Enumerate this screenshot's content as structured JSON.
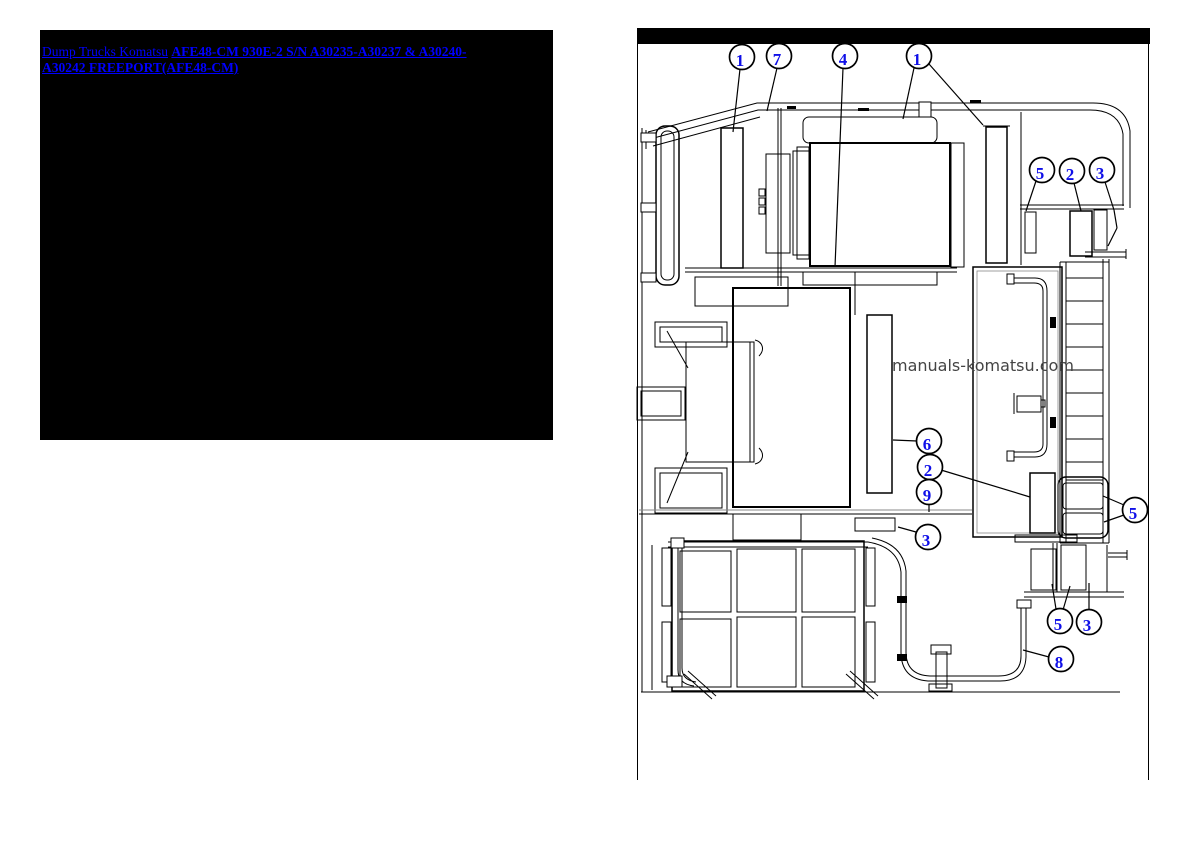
{
  "left_panel": {
    "category_link": "Dump Trucks Komatsu",
    "model_link": "AFE48-CM 930E-2 S/N A30235-A30237 & A30240-A30242 FREEPORT(AFE48-CM)",
    "link_color": "#0000ff",
    "bg_color": "#000000"
  },
  "diagram": {
    "watermark": "manuals-komatsu.com",
    "callout_color": "#0f0fe8",
    "callouts": [
      {
        "label": "1",
        "cx": 742,
        "cy": 57,
        "leaders": [
          [
            740,
            69,
            733,
            132
          ]
        ]
      },
      {
        "label": "7",
        "cx": 779,
        "cy": 56,
        "leaders": [
          [
            777,
            68,
            767,
            111
          ]
        ]
      },
      {
        "label": "4",
        "cx": 845,
        "cy": 56,
        "leaders": [
          [
            843,
            68,
            835,
            267
          ]
        ]
      },
      {
        "label": "1",
        "cx": 919,
        "cy": 56,
        "leaders": [
          [
            914,
            68,
            903,
            119
          ],
          [
            929,
            64,
            983,
            125
          ]
        ]
      },
      {
        "label": "5",
        "cx": 1042,
        "cy": 170,
        "leaders": [
          [
            1036,
            181,
            1026,
            211
          ]
        ]
      },
      {
        "label": "2",
        "cx": 1072,
        "cy": 171,
        "leaders": [
          [
            1074,
            183,
            1081,
            211
          ]
        ]
      },
      {
        "label": "3",
        "cx": 1102,
        "cy": 170,
        "leaders": [
          [
            1105,
            182,
            1114,
            210
          ],
          [
            1114,
            210,
            1117,
            228
          ],
          [
            1117,
            228,
            1108,
            246
          ]
        ]
      },
      {
        "label": "6",
        "cx": 929,
        "cy": 441,
        "leaders": [
          [
            917,
            441,
            893,
            440
          ]
        ]
      },
      {
        "label": "2",
        "cx": 930,
        "cy": 467,
        "leaders": [
          [
            941,
            470,
            1030,
            497
          ]
        ]
      },
      {
        "label": "9",
        "cx": 929,
        "cy": 492,
        "leaders": [
          [
            929,
            504,
            929,
            512
          ]
        ]
      },
      {
        "label": "3",
        "cx": 928,
        "cy": 537,
        "leaders": [
          [
            916,
            532,
            898,
            527
          ]
        ]
      },
      {
        "label": "5",
        "cx": 1135,
        "cy": 510,
        "leaders": [
          [
            1124,
            505,
            1103,
            496
          ],
          [
            1124,
            515,
            1104,
            522
          ]
        ]
      },
      {
        "label": "5",
        "cx": 1060,
        "cy": 621,
        "leaders": [
          [
            1056,
            609,
            1052,
            584
          ],
          [
            1063,
            610,
            1070,
            586
          ]
        ]
      },
      {
        "label": "3",
        "cx": 1089,
        "cy": 622,
        "leaders": [
          [
            1089,
            610,
            1089,
            583
          ]
        ]
      },
      {
        "label": "8",
        "cx": 1061,
        "cy": 659,
        "leaders": [
          [
            1049,
            657,
            1023,
            650
          ]
        ]
      }
    ]
  }
}
